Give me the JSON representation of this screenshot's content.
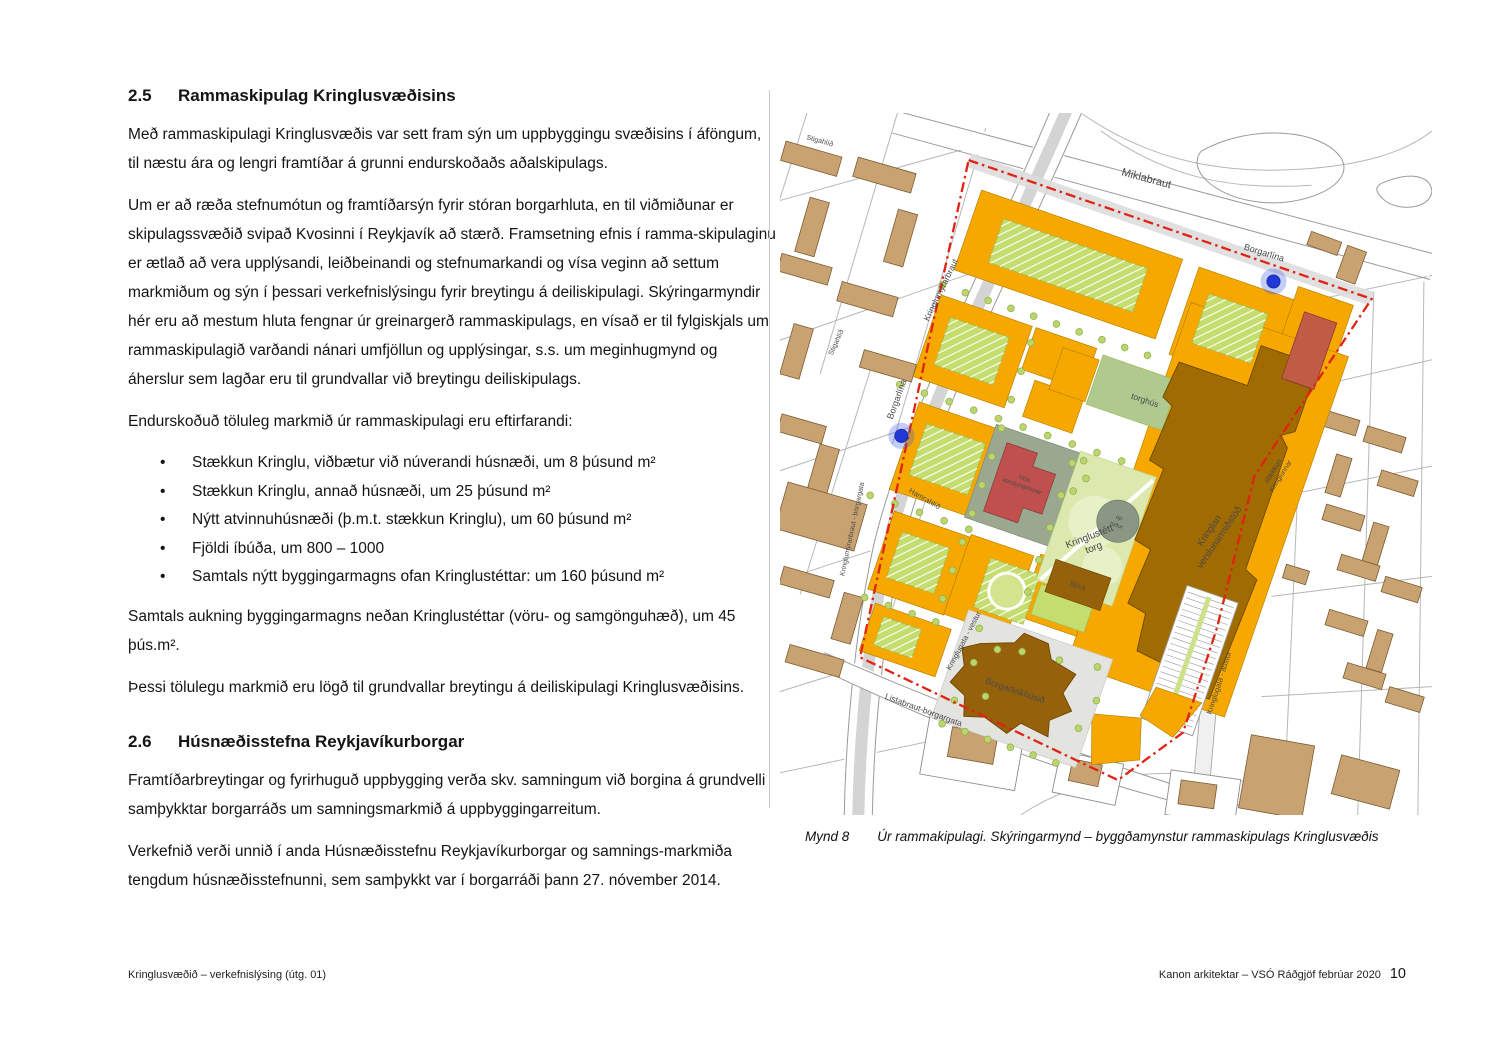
{
  "doc": {
    "s25": {
      "number": "2.5",
      "title": "Rammaskipulag Kringlusvæðisins",
      "p1": "Með rammaskipulagi Kringlusvæðis var sett fram sýn um uppbyggingu svæðisins í áföngum, til næstu ára og lengri framtíðar á grunni endurskoðaðs aðalskipulags.",
      "p2": "Um er að ræða stefnumótun og framtíðarsýn fyrir stóran borgarhluta, en til viðmiðunar er skipulagssvæðið svipað Kvosinni í Reykjavík að stærð. Framsetning efnis í ramma-skipulaginu er ætlað að vera upplýsandi, leiðbeinandi og stefnumarkandi og vísa veginn að settum markmiðum og sýn í þessari verkefnislýsingu fyrir breytingu á deiliskipulagi. Skýringarmyndir hér eru að mestum hluta fengnar úr greinargerð rammaskipulags, en vísað er til fylgiskjals um rammaskipulagið varðandi nánari umfjöllun og upplýsingar, s.s. um meginhugmynd og áherslur sem lagðar eru til grundvallar við breytingu deiliskipulags.",
      "p3": "Endurskoðuð töluleg markmið úr rammaskipulagi eru eftirfarandi:",
      "bullets": [
        "Stækkun Kringlu, viðbætur við núverandi húsnæði, um 8 þúsund m²",
        "Stækkun Kringlu, annað húsnæði, um 25 þúsund m²",
        "Nýtt atvinnuhúsnæði (þ.m.t. stækkun Kringlu), um 60 þúsund m²",
        "Fjöldi íbúða, um 800 – 1000",
        "Samtals nýtt byggingarmagns ofan Kringlustéttar: um 160 þúsund m²"
      ],
      "p4": "Samtals aukning byggingarmagns neðan Kringlustéttar (vöru- og samgönguhæð), um 45 þús.m².",
      "p5": "Þessi tölulegu markmið eru lögð til grundvallar breytingu á deiliskipulagi Kringlusvæðisins."
    },
    "s26": {
      "number": "2.6",
      "title": "Húsnæðisstefna Reykjavíkurborgar",
      "p1": "Framtíðarbreytingar og fyrirhuguð uppbygging verða skv. samningum við borgina á grundvelli samþykktar borgarráðs um samningsmarkmið á uppbyggingarreitum.",
      "p2": "Verkefnið verði unnið í anda Húsnæðisstefnu Reykjavíkurborgar og samnings-markmiða tengdum húsnæðisstefnunni, sem samþykkt var í borgarráði þann 27. nóvember 2014."
    }
  },
  "figure": {
    "caption_label": "Mynd 8",
    "caption_text": "Úr rammakipulagi.  Skýringarmynd – byggðamynstur rammaskipulags Kringlusvæðis"
  },
  "map": {
    "labels": {
      "miklabraut": "Miklabraut",
      "borgarlina_top": "Borgarlína",
      "borgarlina_left": "Borgarlína",
      "kringlumyrarbraut": "Kringlumýrarbraut",
      "kringlumyrarbraut_borgargata": "Kringlumýrarbraut - borgargata",
      "stigahlid_top": "Stigahlíð",
      "stigahlid_left": "Stigahlíð",
      "hamrahlid": "Hamrahlíð",
      "listabraut": "Listabraut-borgargata",
      "kringlugata_vestur": "Kringlugata - vestur",
      "kringlugata_austur": "Kringlugata - austur",
      "kringlan_1": "Kringlan",
      "kringlan_2": "verslunarmiðstöð",
      "borgarleikhus": "Borgarleikhúsið",
      "staekkun_1": "stækkun",
      "staekkun_2": "Kringlunnar",
      "torghus": "torghús",
      "torg_1": "Kringlustétt",
      "torg_2": "torg",
      "hus_verslunarinnar_1": "Hús",
      "hus_verslunarinnar_2": "verslunarinnar",
      "op_nidur_1": "op",
      "op_nidur_2": "niður",
      "sjova": "Sjóvá"
    },
    "colors": {
      "block_orange": "#F6A800",
      "mall_brown": "#A06B00",
      "theatre_brown": "#96610B",
      "red_building": "#C0504D",
      "terracotta_building": "#C05B45",
      "courtyard_green": "#C5DC6F",
      "plaza_green": "#DCE9AE",
      "boundary_red": "#E02313",
      "station_blue": "#2038D6",
      "context_tan": "#C9A271"
    }
  },
  "footer": {
    "left": "Kringlusvæðið – verkefnislýsing (útg. 01)",
    "right": "Kanon arkitektar – VSÓ Ráðgjöf febrúar 2020",
    "page_number": "10"
  }
}
